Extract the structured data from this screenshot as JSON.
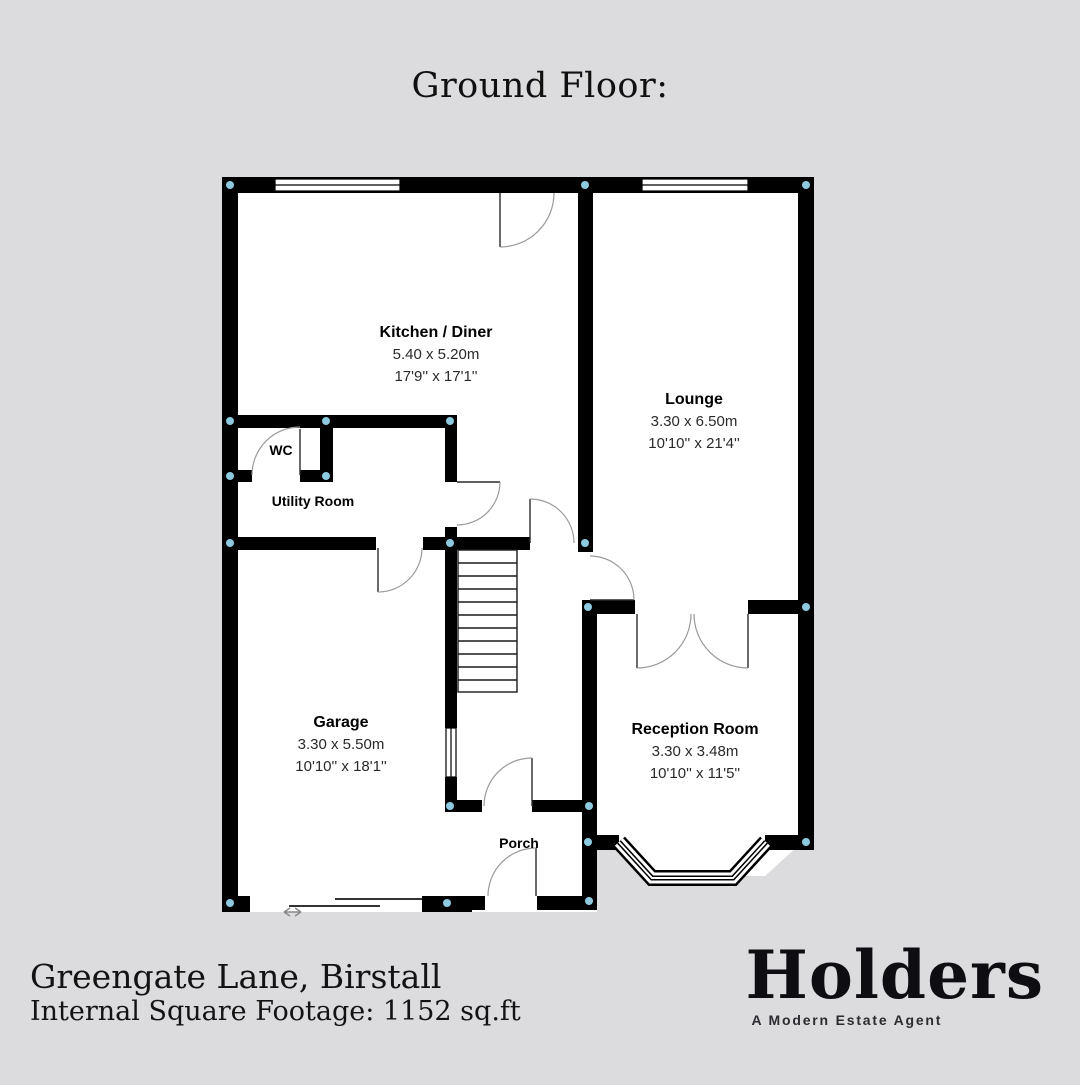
{
  "header": {
    "title": "Ground Floor:"
  },
  "plan": {
    "rooms": [
      {
        "name": "Kitchen / Diner",
        "dims_m": "5.40 x 5.20m",
        "dims_ft": "17'9'' x 17'1''"
      },
      {
        "name": "Lounge",
        "dims_m": "3.30 x 6.50m",
        "dims_ft": "10'10'' x 21'4''"
      },
      {
        "name": "WC"
      },
      {
        "name": "Utility Room"
      },
      {
        "name": "Garage",
        "dims_m": "3.30 x 5.50m",
        "dims_ft": "10'10'' x 18'1''"
      },
      {
        "name": "Reception Room",
        "dims_m": "3.30 x 3.48m",
        "dims_ft": "10'10'' x 11'5''"
      },
      {
        "name": "Porch"
      }
    ],
    "colors": {
      "wall": "#000000",
      "floor": "#ffffff",
      "background": "#dcdcde",
      "junction_marker": "#8ecadf",
      "door_arc": "#9a9a9a"
    }
  },
  "footer": {
    "address": "Greengate Lane, Birstall",
    "footage": "Internal Square Footage: 1152 sq.ft"
  },
  "brand": {
    "logo": "Holders",
    "tagline": "A Modern Estate Agent"
  }
}
